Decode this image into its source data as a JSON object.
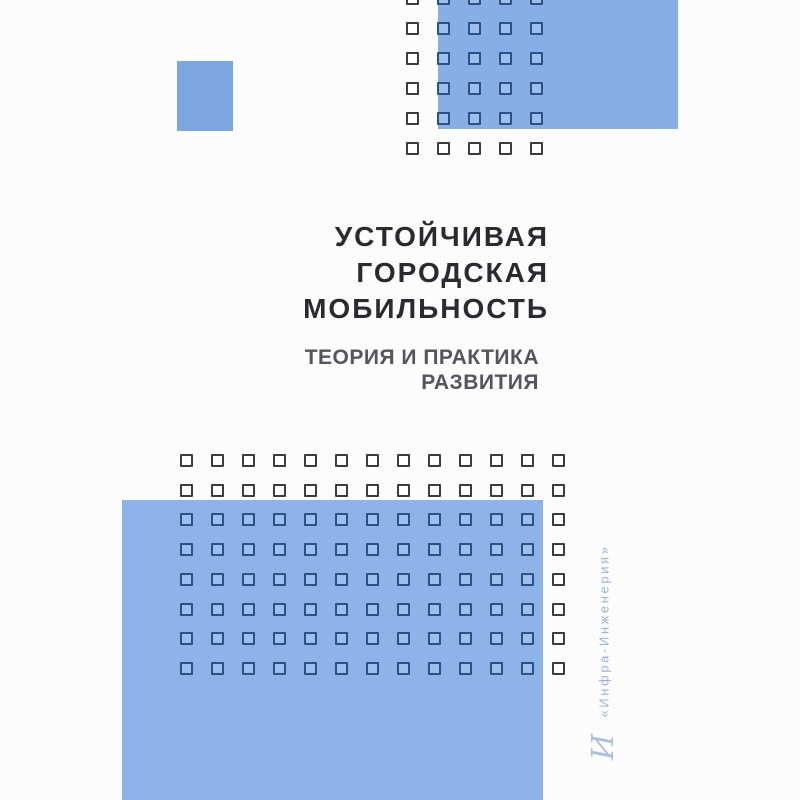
{
  "cover": {
    "title_lines": [
      "УСТОЙЧИВАЯ",
      "ГОРОДСКАЯ",
      "МОБИЛЬНОСТЬ"
    ],
    "subtitle_lines": [
      "ТЕОРИЯ И ПРАКТИКА",
      "РАЗВИТИЯ"
    ],
    "publisher": "«Инфра-Инженерия»",
    "publisher_logo_glyph": "И"
  },
  "decor": {
    "top_grid": {
      "rows": 6,
      "cols": 5
    },
    "bottom_grid": {
      "rows": 8,
      "cols": 13
    }
  },
  "colors": {
    "background": "#fcfcfd",
    "rect_top_right": "#88afe5",
    "rect_top_left": "#7ea7e2",
    "rect_bottom": "#8db3e8",
    "title_text": "#2a2a2f",
    "subtitle_text": "#55565b",
    "publisher_text": "#9db2d8",
    "publisher_logo": "#abbfdf",
    "square_outline_on_white": "#3c3c3e",
    "square_outline_on_blue": "#2a5284",
    "square_fill_on_blue": "#9dbfef"
  }
}
